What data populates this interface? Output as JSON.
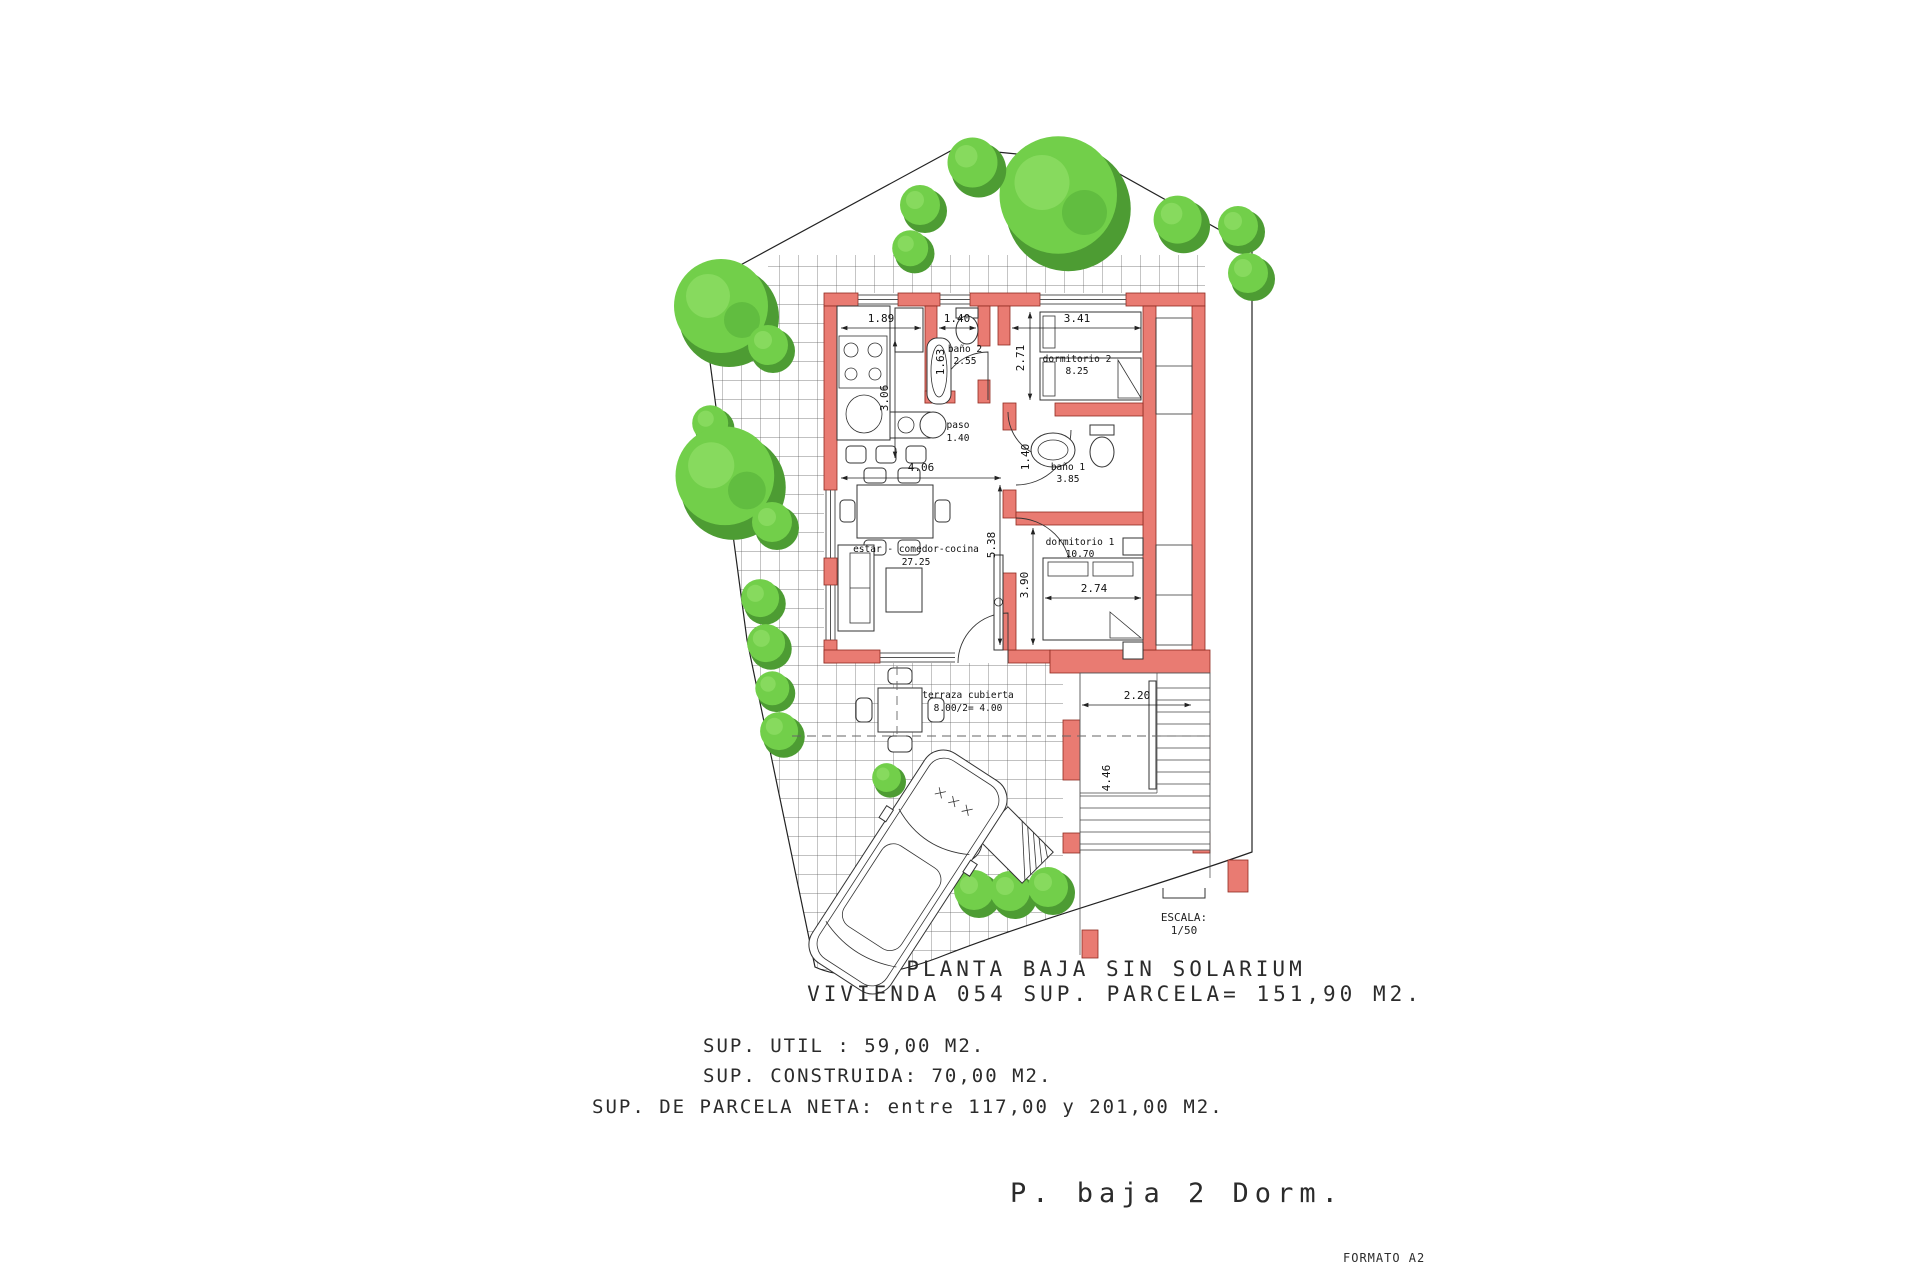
{
  "colors": {
    "wall_fill": "#e97b72",
    "wall_outline": "#8f2b20",
    "tree_base": "#72cf4a",
    "tree_shadow": "#4d9c33",
    "tree_light": "#8fdd66",
    "line": "#222222",
    "background": "#ffffff"
  },
  "plan": {
    "captions": {
      "title": "PLANTA BAJA SIN SOLARIUM",
      "subtitle": "VIVIENDA 054 SUP. PARCELA= 151,90 M2.",
      "sup_util": "SUP. UTIL : 59,00 M2.",
      "sup_construida": "SUP. CONSTRUIDA: 70,00 M2.",
      "sup_parcela": "SUP. DE PARCELA NETA: entre 117,00 y 201,00 M2.",
      "footer": "P. baja 2 Dorm.",
      "format": "FORMATO A2"
    },
    "scale_block": {
      "label": "ESCALA:",
      "value": "1/50"
    },
    "rooms": {
      "bano2": {
        "name": "baño 2",
        "area": "2.55"
      },
      "paso": {
        "name": "paso",
        "area": "1.40"
      },
      "dorm2": {
        "name": "dormitorio 2",
        "area": "8.25"
      },
      "bano1": {
        "name": "baño 1",
        "area": "3.85"
      },
      "dorm1": {
        "name": "dormitorio 1",
        "area": "10.70"
      },
      "estar": {
        "name": "estar - comedor-cocina",
        "area": "27.25"
      },
      "terraza": {
        "name": "terraza cubierta",
        "area": "8.00/2= 4.00"
      }
    },
    "dims": {
      "kitchen_w": "1.89",
      "bano2_w": "1.40",
      "dorm2_w": "3.41",
      "kitchen_d": "3.06",
      "bano2_d": "1.63",
      "dorm2_d": "2.71",
      "living_w": "4.06",
      "living_d": "5.38",
      "bano1_d": "1.40",
      "dorm1_d": "3.90",
      "bed1_w": "2.74",
      "stairs_w": "2.20",
      "stairs_d": "4.46"
    }
  }
}
